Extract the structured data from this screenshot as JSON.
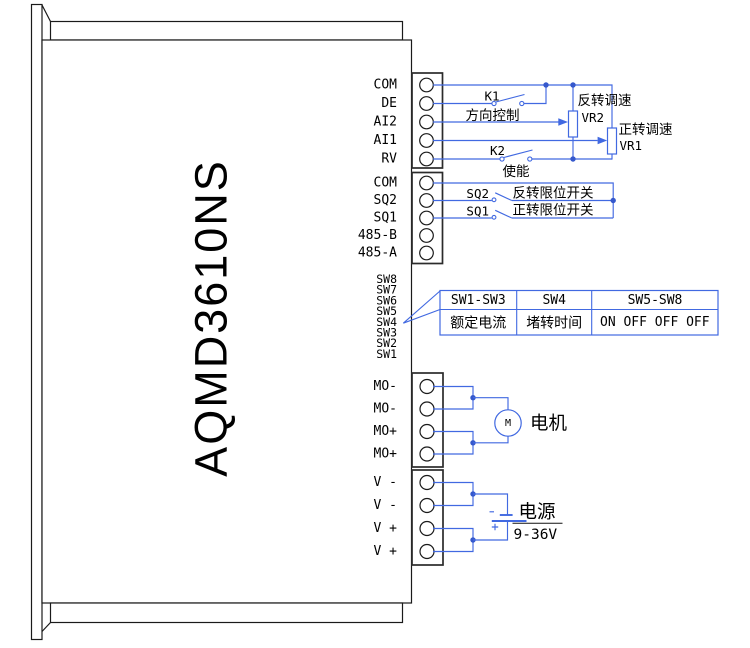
{
  "device": {
    "model": "AQMD3610NS"
  },
  "blocks": {
    "b1": {
      "pins": [
        "COM",
        "DE",
        "AI2",
        "AI1",
        "RV"
      ]
    },
    "b2": {
      "pins": [
        "COM",
        "SQ2",
        "SQ1",
        "485-B",
        "485-A"
      ]
    },
    "b3": {
      "pins": [
        "MO-",
        "MO-",
        "MO+",
        "MO+"
      ]
    },
    "b4": {
      "pins": [
        "V -",
        "V -",
        "V +",
        "V +"
      ]
    }
  },
  "dip": {
    "labels": [
      "SW8",
      "SW7",
      "SW6",
      "SW5",
      "SW4",
      "SW3",
      "SW2",
      "SW1"
    ]
  },
  "wiring": {
    "k1_label": "K1",
    "k1_caption": "方向控制",
    "k2_label": "K2",
    "k2_caption": "使能",
    "vr2_caption": "反转调速",
    "vr2_label": "VR2",
    "vr1_caption": "正转调速",
    "vr1_label": "VR1",
    "sq2_label": "SQ2",
    "sq2_caption": "反转限位开关",
    "sq1_label": "SQ1",
    "sq1_caption": "正转限位开关",
    "motor_symbol": "M",
    "motor_caption": "电机",
    "power_caption": "电源",
    "power_voltage": "9-36V",
    "battery_minus": "-",
    "battery_plus": "+"
  },
  "dip_table": {
    "headers": [
      "SW1-SW3",
      "SW4",
      "SW5-SW8"
    ],
    "values": [
      "额定电流",
      "堵转时间",
      "ON OFF OFF OFF"
    ]
  },
  "colors": {
    "wire": "#4169E1",
    "outline": "#000000",
    "text": "#000000"
  }
}
